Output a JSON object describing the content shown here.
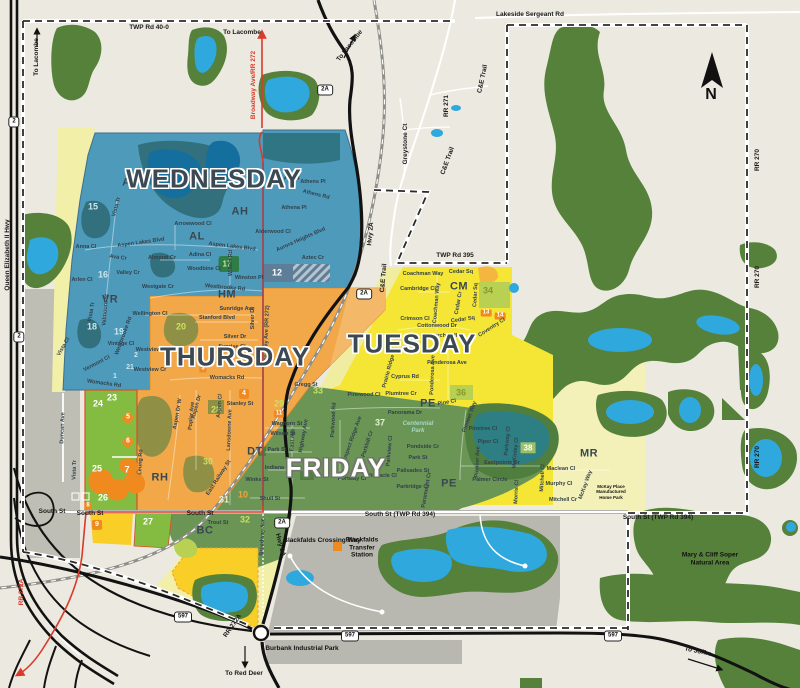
{
  "days": {
    "wednesday": "WEDNESDAY",
    "thursday": "THURSDAY",
    "tuesday": "TUESDAY",
    "friday": "FRIDAY"
  },
  "north_label": "N",
  "colors": {
    "wednesday": "#4E9ABB",
    "thursday": "#F2A849",
    "tuesday": "#F5E636",
    "friday": "#6A9555",
    "light_green_zone": "#83BC41",
    "park_green": "#55813B",
    "water": "#2FA8DE",
    "highway_red": "#D93A2B",
    "pale_yellow": "#F2EFA9",
    "bright_yellow": "#F8CE27",
    "urban_gray": "#BDBCB2",
    "marker_orange": "#F18A1E"
  },
  "map_labels": {
    "letters": [
      {
        "t": "AL",
        "x": 130,
        "y": 183
      },
      {
        "t": "AH",
        "x": 292,
        "y": 177
      },
      {
        "t": "AH",
        "x": 240,
        "y": 212
      },
      {
        "t": "AL",
        "x": 197,
        "y": 237
      },
      {
        "t": "VR",
        "x": 110,
        "y": 300
      },
      {
        "t": "HM",
        "x": 227,
        "y": 295
      },
      {
        "t": "CM",
        "x": 459,
        "y": 287
      },
      {
        "t": "PE",
        "x": 428,
        "y": 404
      },
      {
        "t": "PE",
        "x": 449,
        "y": 484
      },
      {
        "t": "DT",
        "x": 255,
        "y": 452
      },
      {
        "t": "RH",
        "x": 160,
        "y": 478
      },
      {
        "t": "BC",
        "x": 205,
        "y": 531
      },
      {
        "t": "MR",
        "x": 589,
        "y": 454
      }
    ],
    "numbers": [
      {
        "t": "15",
        "x": 93,
        "y": 207,
        "c": "n-teal"
      },
      {
        "t": "16",
        "x": 103,
        "y": 275,
        "c": "n-teal"
      },
      {
        "t": "18",
        "x": 92,
        "y": 327,
        "c": "n-teal"
      },
      {
        "t": "19",
        "x": 119,
        "y": 332,
        "c": "n-teal"
      },
      {
        "t": "2",
        "x": 136,
        "y": 356,
        "c": "n-teal-sm"
      },
      {
        "t": "21",
        "x": 130,
        "y": 368,
        "c": "n-teal-sm"
      },
      {
        "t": "1",
        "x": 115,
        "y": 377,
        "c": "n-teal-sm"
      },
      {
        "t": "17",
        "x": 227,
        "y": 264,
        "c": "boxg"
      },
      {
        "t": "12",
        "x": 277,
        "y": 273,
        "c": "n-white"
      },
      {
        "t": "20",
        "x": 181,
        "y": 327,
        "c": "n-lime"
      },
      {
        "t": "28",
        "x": 216,
        "y": 410,
        "c": "n-lime"
      },
      {
        "t": "30",
        "x": 208,
        "y": 462,
        "c": "n-lime"
      },
      {
        "t": "3",
        "x": 203,
        "y": 369,
        "c": "badge-sm"
      },
      {
        "t": "4",
        "x": 244,
        "y": 394,
        "c": "badge"
      },
      {
        "t": "23",
        "x": 112,
        "y": 398,
        "c": "n-white"
      },
      {
        "t": "24",
        "x": 98,
        "y": 404,
        "c": "n-white"
      },
      {
        "t": "25",
        "x": 97,
        "y": 469,
        "c": "n-white"
      },
      {
        "t": "26",
        "x": 103,
        "y": 498,
        "c": "n-white"
      },
      {
        "t": "27",
        "x": 148,
        "y": 522,
        "c": "n-white"
      },
      {
        "t": "5",
        "x": 128,
        "y": 418,
        "c": "diamond"
      },
      {
        "t": "6",
        "x": 128,
        "y": 442,
        "c": "diamond"
      },
      {
        "t": "7",
        "x": 127,
        "y": 470,
        "c": "n-white"
      },
      {
        "t": "8",
        "x": 88,
        "y": 506,
        "c": "badge-sm"
      },
      {
        "t": "9",
        "x": 97,
        "y": 525,
        "c": "badge"
      },
      {
        "t": "29",
        "x": 279,
        "y": 404,
        "c": "n-lime"
      },
      {
        "t": "11",
        "x": 279,
        "y": 414,
        "c": "badge-sm"
      },
      {
        "t": "10",
        "x": 243,
        "y": 495,
        "c": "n-orange"
      },
      {
        "t": "31",
        "x": 224,
        "y": 500,
        "c": "n-pale"
      },
      {
        "t": "32",
        "x": 245,
        "y": 520,
        "c": "n-lime"
      },
      {
        "t": "33",
        "x": 318,
        "y": 391,
        "c": "n-lime"
      },
      {
        "t": "37",
        "x": 380,
        "y": 423,
        "c": "n-pale"
      },
      {
        "t": "34",
        "x": 488,
        "y": 291,
        "c": "n-olive"
      },
      {
        "t": "36",
        "x": 461,
        "y": 393,
        "c": "n-olive"
      },
      {
        "t": "38",
        "x": 528,
        "y": 448,
        "c": "boxp"
      },
      {
        "t": "13",
        "x": 486,
        "y": 313,
        "c": "badge-sm"
      },
      {
        "t": "14",
        "x": 500,
        "y": 316,
        "c": "badge-sm"
      }
    ],
    "streets": [
      {
        "t": "Vista Tr",
        "x": 117,
        "y": 207,
        "r": -75
      },
      {
        "t": "Anna Cl",
        "x": 86,
        "y": 247
      },
      {
        "t": "Aspen Lakes Blvd",
        "x": 141,
        "y": 243,
        "r": -8
      },
      {
        "t": "Arlen Cl",
        "x": 82,
        "y": 280
      },
      {
        "t": "Ava Cr",
        "x": 118,
        "y": 258,
        "r": 8
      },
      {
        "t": "Valley Cr",
        "x": 128,
        "y": 273
      },
      {
        "t": "Arrowwood Cl",
        "x": 193,
        "y": 224
      },
      {
        "t": "Almond Cr",
        "x": 162,
        "y": 258
      },
      {
        "t": "Adina Cl",
        "x": 200,
        "y": 255
      },
      {
        "t": "Aspen Lakes Blvd",
        "x": 232,
        "y": 247,
        "r": 7
      },
      {
        "t": "Westgate Cr",
        "x": 158,
        "y": 287
      },
      {
        "t": "Woodbine Cl",
        "x": 204,
        "y": 269
      },
      {
        "t": "Westbrooke Rd",
        "x": 225,
        "y": 288,
        "r": 5
      },
      {
        "t": "Winston Pl",
        "x": 249,
        "y": 278
      },
      {
        "t": "Willow Rd",
        "x": 231,
        "y": 263,
        "r": -90
      },
      {
        "t": "Athens Pl",
        "x": 313,
        "y": 182
      },
      {
        "t": "Athens Rd",
        "x": 316,
        "y": 195,
        "r": 14
      },
      {
        "t": "Athena Pl",
        "x": 294,
        "y": 208
      },
      {
        "t": "Alderwood Cl",
        "x": 273,
        "y": 232
      },
      {
        "t": "Aurora Heights Blvd",
        "x": 301,
        "y": 240,
        "r": -24
      },
      {
        "t": "Aztec Cr",
        "x": 313,
        "y": 258
      },
      {
        "t": "Vista Tr",
        "x": 92,
        "y": 312,
        "r": -80
      },
      {
        "t": "Valmount St",
        "x": 106,
        "y": 310,
        "r": -85
      },
      {
        "t": "Vintage Cl",
        "x": 121,
        "y": 344
      },
      {
        "t": "Vermont Cl",
        "x": 97,
        "y": 364,
        "r": -28
      },
      {
        "t": "Vista Cl",
        "x": 64,
        "y": 347,
        "r": -60
      },
      {
        "t": "Womacks Rd",
        "x": 104,
        "y": 384,
        "r": 8
      },
      {
        "t": "Westbrooke Rd",
        "x": 124,
        "y": 336,
        "r": -70
      },
      {
        "t": "Wellington Cl",
        "x": 150,
        "y": 314
      },
      {
        "t": "Sunridge Ave",
        "x": 237,
        "y": 309
      },
      {
        "t": "Stanford Blvd",
        "x": 217,
        "y": 318
      },
      {
        "t": "Silver Dr",
        "x": 253,
        "y": 318,
        "r": -90
      },
      {
        "t": "Silver Dr",
        "x": 235,
        "y": 337
      },
      {
        "t": "Sunrise Cl",
        "x": 232,
        "y": 347
      },
      {
        "t": "Westview Cr",
        "x": 152,
        "y": 350
      },
      {
        "t": "Westview Cr",
        "x": 150,
        "y": 370
      },
      {
        "t": "Womacks Rd",
        "x": 227,
        "y": 378
      },
      {
        "t": "Stanley St",
        "x": 240,
        "y": 404
      },
      {
        "t": "Gregg St",
        "x": 306,
        "y": 385
      },
      {
        "t": "Aspen Dr W",
        "x": 178,
        "y": 414,
        "r": -80
      },
      {
        "t": "Aspen Dr",
        "x": 197,
        "y": 407,
        "r": -75
      },
      {
        "t": "Poplar Ave",
        "x": 192,
        "y": 416,
        "r": -85
      },
      {
        "t": "Aspen Cl",
        "x": 220,
        "y": 406,
        "r": -85
      },
      {
        "t": "Lansdowne Ave",
        "x": 230,
        "y": 430,
        "r": -88
      },
      {
        "t": "Leung Rd",
        "x": 141,
        "y": 462,
        "r": -87
      },
      {
        "t": "Broadway Ave (RR 272)",
        "x": 267,
        "y": 336,
        "r": -88
      },
      {
        "t": "East Railway St",
        "x": 219,
        "y": 478,
        "r": -57
      },
      {
        "t": "Coachman Way",
        "x": 423,
        "y": 274
      },
      {
        "t": "Cedar Sq",
        "x": 461,
        "y": 272
      },
      {
        "t": "Cedar Sq",
        "x": 463,
        "y": 320,
        "r": -8
      },
      {
        "t": "Cedar Sq",
        "x": 476,
        "y": 295,
        "r": -87
      },
      {
        "t": "Cambridge Cl",
        "x": 418,
        "y": 289
      },
      {
        "t": "Coachman Way",
        "x": 437,
        "y": 303,
        "r": -85
      },
      {
        "t": "Crimson Cl",
        "x": 415,
        "y": 319
      },
      {
        "t": "Cedar Cr",
        "x": 459,
        "y": 303,
        "r": -80
      },
      {
        "t": "Cottonwood Dr",
        "x": 437,
        "y": 326
      },
      {
        "t": "Coventry Cl",
        "x": 492,
        "y": 328,
        "r": -33
      },
      {
        "t": "Churchill Pl",
        "x": 442,
        "y": 336
      },
      {
        "t": "Ponderosa Ave",
        "x": 447,
        "y": 363
      },
      {
        "t": "Ponderosa Ave",
        "x": 433,
        "y": 375,
        "r": -88
      },
      {
        "t": "Cyprus Rd",
        "x": 405,
        "y": 377
      },
      {
        "t": "Plumtree Cr",
        "x": 401,
        "y": 394
      },
      {
        "t": "Pine Cl",
        "x": 447,
        "y": 403,
        "r": -10
      },
      {
        "t": "Pinewood Cl",
        "x": 364,
        "y": 395
      },
      {
        "t": "Prairie Ridge Cl",
        "x": 390,
        "y": 368,
        "r": -75
      },
      {
        "t": "Pinetree Cl",
        "x": 483,
        "y": 429
      },
      {
        "t": "Piper Cl",
        "x": 488,
        "y": 442
      },
      {
        "t": "Parkway Cl",
        "x": 508,
        "y": 441,
        "r": -85
      },
      {
        "t": "Pioneer Ave",
        "x": 478,
        "y": 462,
        "r": -87
      },
      {
        "t": "Pioneer Way",
        "x": 470,
        "y": 417,
        "r": -70
      },
      {
        "t": "Eastpointe Dr",
        "x": 502,
        "y": 463
      },
      {
        "t": "McKinley Cl",
        "x": 516,
        "y": 453,
        "r": -85
      },
      {
        "t": "Palmer Circle",
        "x": 490,
        "y": 480
      },
      {
        "t": "Morris Cl",
        "x": 517,
        "y": 492,
        "r": -87
      },
      {
        "t": "Maclean Cl",
        "x": 561,
        "y": 469
      },
      {
        "t": "Murphy Cl",
        "x": 559,
        "y": 484
      },
      {
        "t": "Mitchell Cr",
        "x": 563,
        "y": 500
      },
      {
        "t": "Mitchell Cl",
        "x": 543,
        "y": 478,
        "r": -87
      },
      {
        "t": "McKay Way",
        "x": 586,
        "y": 485,
        "r": -70
      },
      {
        "t": "Panorama Dr",
        "x": 405,
        "y": 413
      },
      {
        "t": "Pondside Cr",
        "x": 423,
        "y": 447
      },
      {
        "t": "Park St",
        "x": 418,
        "y": 458
      },
      {
        "t": "Palisades St",
        "x": 413,
        "y": 471
      },
      {
        "t": "Parkridge Cr",
        "x": 413,
        "y": 487
      },
      {
        "t": "Pinnacle Cl",
        "x": 382,
        "y": 476
      },
      {
        "t": "Portway Cl",
        "x": 352,
        "y": 479
      },
      {
        "t": "Paramount Cr",
        "x": 427,
        "y": 490,
        "r": -80
      },
      {
        "t": "Parkview Cl",
        "x": 390,
        "y": 451,
        "r": -85
      },
      {
        "t": "Parkwood Rd",
        "x": 334,
        "y": 420,
        "r": -87
      },
      {
        "t": "Prospect Ridge Ave",
        "x": 352,
        "y": 441,
        "r": -70
      },
      {
        "t": "Parkhill Cr",
        "x": 368,
        "y": 444,
        "r": -72
      },
      {
        "t": "Waghorn St",
        "x": 287,
        "y": 424
      },
      {
        "t": "Wilson St",
        "x": 283,
        "y": 434
      },
      {
        "t": "Park St",
        "x": 277,
        "y": 450
      },
      {
        "t": "Indiana St",
        "x": 278,
        "y": 468
      },
      {
        "t": "Winks St",
        "x": 257,
        "y": 480
      },
      {
        "t": "Shull St",
        "x": 270,
        "y": 499
      },
      {
        "t": "East Ave",
        "x": 293,
        "y": 440,
        "r": -87
      },
      {
        "t": "Highway Ave",
        "x": 304,
        "y": 436,
        "r": -80
      },
      {
        "t": "Trout St",
        "x": 218,
        "y": 523
      },
      {
        "t": "Broadway Ave",
        "x": 263,
        "y": 537,
        "r": -88
      },
      {
        "t": "Duncan Ave",
        "x": 63,
        "y": 428,
        "r": -88
      },
      {
        "t": "Vista Tr",
        "x": 75,
        "y": 470,
        "r": -88
      }
    ],
    "roads": [
      {
        "t": "TWP Rd 40-0",
        "x": 149,
        "y": 28
      },
      {
        "t": "Lakeside Sergeant Rd",
        "x": 530,
        "y": 15
      },
      {
        "t": "TWP Rd 395",
        "x": 455,
        "y": 256
      },
      {
        "t": "C&E Trail",
        "x": 483,
        "y": 79,
        "r": -78
      },
      {
        "t": "C&E Trail",
        "x": 448,
        "y": 161,
        "r": -70
      },
      {
        "t": "C&E Trail",
        "x": 384,
        "y": 278,
        "r": -85
      },
      {
        "t": "RR 271",
        "x": 447,
        "y": 106,
        "r": -90
      },
      {
        "t": "Greystone Ct",
        "x": 406,
        "y": 144,
        "r": -90
      },
      {
        "t": "RR 270",
        "x": 758,
        "y": 160,
        "r": -90
      },
      {
        "t": "RR 270",
        "x": 758,
        "y": 277,
        "r": -90
      },
      {
        "t": "RR 270",
        "x": 758,
        "y": 457,
        "r": -90
      },
      {
        "t": "South St",
        "x": 52,
        "y": 512
      },
      {
        "t": "South St",
        "x": 90,
        "y": 514
      },
      {
        "t": "South St",
        "x": 200,
        "y": 514
      },
      {
        "t": "South St (TWP Rd 394)",
        "x": 400,
        "y": 515
      },
      {
        "t": "South St (TWP Rd 394)",
        "x": 658,
        "y": 518
      },
      {
        "t": "Queen Elizabeth II Hwy",
        "x": 8,
        "y": 255,
        "r": -90
      },
      {
        "t": "Hwy 2A",
        "x": 371,
        "y": 234,
        "r": -85
      },
      {
        "t": "Hwy 2A",
        "x": 280,
        "y": 545,
        "r": 75
      },
      {
        "t": "RR 272A",
        "x": 22,
        "y": 592,
        "r": -90,
        "c": "red-text"
      },
      {
        "t": "RR 272A",
        "x": 233,
        "y": 626,
        "r": -55
      },
      {
        "t": "Broadway Ave/RR 272",
        "x": 254,
        "y": 85,
        "r": -90,
        "c": "red-text"
      }
    ],
    "directions": [
      {
        "t": "To Lacombe",
        "x": 37,
        "y": 57,
        "r": -90
      },
      {
        "t": "To Lacombe",
        "x": 242,
        "y": 33
      },
      {
        "t": "To Lacombe",
        "x": 350,
        "y": 46,
        "r": -52
      },
      {
        "t": "To Red Deer",
        "x": 244,
        "y": 674
      },
      {
        "t": "To Joffre",
        "x": 698,
        "y": 652,
        "r": 12
      }
    ],
    "places": [
      {
        "t": "Mary & Cliff Soper\nNatural Area",
        "x": 710,
        "y": 559
      },
      {
        "t": "Centennial\nPark",
        "x": 418,
        "y": 428,
        "c": "park-name"
      },
      {
        "t": "McKay Place\nManufactured\nHome Park",
        "x": 611,
        "y": 492,
        "c": "tiny"
      },
      {
        "t": "Blackfalds\nTransfer\nStation",
        "x": 362,
        "y": 548
      },
      {
        "t": "Burbank Industrial Park",
        "x": 302,
        "y": 649
      },
      {
        "t": "Blackfalds Crossing Way",
        "x": 322,
        "y": 541
      }
    ],
    "shields": [
      {
        "t": "2",
        "x": 14,
        "y": 122
      },
      {
        "t": "2",
        "x": 19,
        "y": 337
      },
      {
        "t": "2A",
        "x": 325,
        "y": 90
      },
      {
        "t": "2A",
        "x": 364,
        "y": 294
      },
      {
        "t": "2A",
        "x": 282,
        "y": 523
      },
      {
        "t": "597",
        "x": 183,
        "y": 617
      },
      {
        "t": "597",
        "x": 350,
        "y": 636
      },
      {
        "t": "597",
        "x": 613,
        "y": 636
      }
    ]
  }
}
